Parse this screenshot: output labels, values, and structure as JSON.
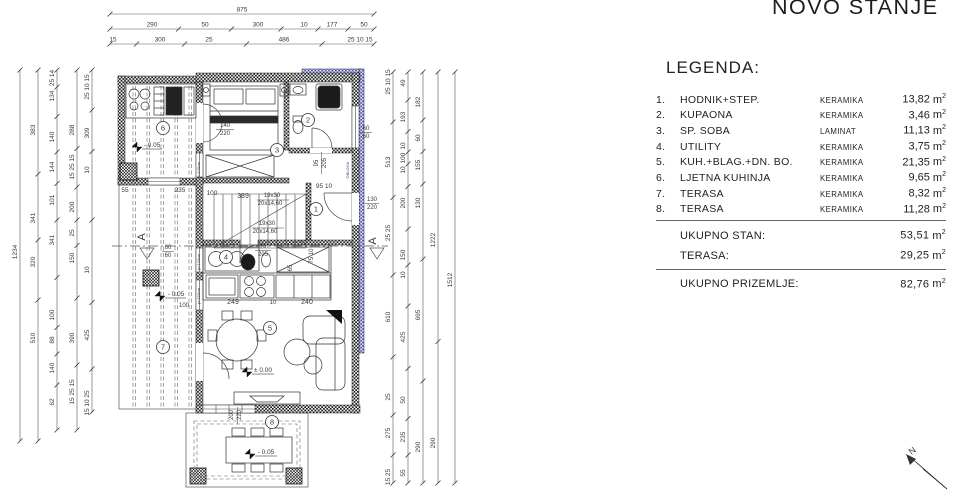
{
  "title": "NOVO STANJE",
  "legend": {
    "heading": "LEGENDA:",
    "unit": "m",
    "unit_sup": "2",
    "items": [
      {
        "num": "1.",
        "name": "HODNIK+STEP.",
        "material": "KERAMIKA",
        "area": "13,82"
      },
      {
        "num": "2.",
        "name": "KUPAONA",
        "material": "KERAMIKA",
        "area": "3,46"
      },
      {
        "num": "3.",
        "name": "SP. SOBA",
        "material": "LAMINAT",
        "area": "11,13"
      },
      {
        "num": "4.",
        "name": "UTILITY",
        "material": "KERAMIKA",
        "area": "3,75"
      },
      {
        "num": "5.",
        "name": "KUH.+BLAG.+DN. BO.",
        "material": "KERAMIKA",
        "area": "21,35"
      },
      {
        "num": "6.",
        "name": "LJETNA KUHINJA",
        "material": "KERAMIKA",
        "area": "9,65"
      },
      {
        "num": "7.",
        "name": "TERASA",
        "material": "KERAMIKA",
        "area": "8,32"
      },
      {
        "num": "8.",
        "name": "TERASA",
        "material": "KERAMIKA",
        "area": "11,28"
      }
    ],
    "subtotals": [
      {
        "label": "UKUPNO STAN:",
        "area": "53,51"
      },
      {
        "label": "TERASA:",
        "area": "29,25"
      }
    ],
    "total": {
      "label": "UKUPNO PRIZEMLJE:",
      "area": "82,76"
    }
  },
  "plan": {
    "rooms": [
      {
        "n": "1",
        "x": 316,
        "y": 209
      },
      {
        "n": "2",
        "x": 308,
        "y": 120
      },
      {
        "n": "3",
        "x": 277,
        "y": 150
      },
      {
        "n": "4",
        "x": 226,
        "y": 257
      },
      {
        "n": "5",
        "x": 270,
        "y": 328
      },
      {
        "n": "6",
        "x": 163,
        "y": 128
      },
      {
        "n": "7",
        "x": 163,
        "y": 347
      },
      {
        "n": "8",
        "x": 272,
        "y": 422
      }
    ],
    "texts": [
      {
        "t": "140",
        "x": 225,
        "y": 127
      },
      {
        "t": "220",
        "x": 225,
        "y": 135
      },
      {
        "t": "- 0.05",
        "x": 152,
        "y": 147,
        "s": 6.5
      },
      {
        "t": "55",
        "x": 125,
        "y": 192,
        "s": 6.5
      },
      {
        "t": "235",
        "x": 180,
        "y": 192,
        "s": 6.5
      },
      {
        "t": "100",
        "x": 212,
        "y": 195,
        "s": 6.5
      },
      {
        "t": "389",
        "x": 243,
        "y": 198,
        "s": 7
      },
      {
        "t": "19x30",
        "x": 272,
        "y": 197,
        "s": 6
      },
      {
        "t": "20x14,60",
        "x": 270,
        "y": 205,
        "s": 6
      },
      {
        "t": "19x30",
        "x": 267,
        "y": 225,
        "s": 6
      },
      {
        "t": "20x14,60",
        "x": 265,
        "y": 233,
        "s": 6
      },
      {
        "t": "125",
        "x": 299,
        "y": 245,
        "s": 7
      },
      {
        "t": "95",
        "x": 318,
        "y": 163,
        "r": -90
      },
      {
        "t": "205",
        "x": 326,
        "y": 163,
        "r": -90
      },
      {
        "t": "95 10",
        "x": 324,
        "y": 188,
        "s": 6.5
      },
      {
        "t": "75",
        "x": 263,
        "y": 248
      },
      {
        "t": "205",
        "x": 263,
        "y": 256
      },
      {
        "t": "65",
        "x": 292,
        "y": 268,
        "r": -90
      },
      {
        "t": "75 10",
        "x": 313,
        "y": 256,
        "r": -90
      },
      {
        "t": "249",
        "x": 233,
        "y": 304,
        "s": 7
      },
      {
        "t": "10",
        "x": 273,
        "y": 304
      },
      {
        "t": "240",
        "x": 307,
        "y": 304,
        "s": 7
      },
      {
        "t": "± 0.00",
        "x": 263,
        "y": 372,
        "s": 6.5
      },
      {
        "t": "- 0.05",
        "x": 176,
        "y": 296,
        "s": 6.5
      },
      {
        "t": "100",
        "x": 184,
        "y": 307
      },
      {
        "t": "- 0.05",
        "x": 266,
        "y": 454,
        "s": 6.5
      },
      {
        "t": "200",
        "x": 233,
        "y": 415,
        "r": -90
      },
      {
        "t": "220",
        "x": 241,
        "y": 415,
        "r": -90
      },
      {
        "t": "60",
        "x": 366,
        "y": 130
      },
      {
        "t": "60",
        "x": 366,
        "y": 138
      },
      {
        "t": "130",
        "x": 372,
        "y": 201
      },
      {
        "t": "220",
        "x": 372,
        "y": 209
      },
      {
        "t": "60",
        "x": 168,
        "y": 249
      },
      {
        "t": "60",
        "x": 168,
        "y": 257
      },
      {
        "t": "p=100cm",
        "x": 200,
        "y": 170,
        "r": -90,
        "s": 4
      },
      {
        "t": "p=140cm",
        "x": 200,
        "y": 262,
        "r": -90,
        "s": 4
      },
      {
        "t": "p=160cm",
        "x": 200,
        "y": 296,
        "r": -90,
        "s": 4
      },
      {
        "t": "OBLOGA",
        "x": 349,
        "y": 170,
        "r": -90,
        "s": 4,
        "c": "#4040b0"
      },
      {
        "t": "A",
        "x": 145,
        "y": 237,
        "r": -90,
        "s": 11
      },
      {
        "t": "A",
        "x": 376,
        "y": 241,
        "r": -90,
        "s": 11
      },
      {
        "t": "N",
        "x": 914,
        "y": 453,
        "r": -38,
        "s": 9
      }
    ],
    "dims": {
      "top": [
        {
          "y": 14,
          "x1": 110,
          "x2": 374,
          "labels": [
            {
              "t": "875",
              "at": 242
            }
          ]
        },
        {
          "y": 29,
          "x1": 110,
          "x2": 374,
          "labels": [
            {
              "t": "290",
              "at": 152
            },
            {
              "t": "50",
              "at": 205
            },
            {
              "t": "300",
              "at": 258
            },
            {
              "t": "10",
              "at": 304
            },
            {
              "t": "177",
              "at": 332
            },
            {
              "t": "50",
              "at": 364
            }
          ]
        },
        {
          "y": 44,
          "x1": 110,
          "x2": 374,
          "labels": [
            {
              "t": "15",
              "at": 113
            },
            {
              "t": "300",
              "at": 160
            },
            {
              "t": "25",
              "at": 209
            },
            {
              "t": "486",
              "at": 284
            },
            {
              "t": "25 10 15",
              "at": 360
            }
          ]
        }
      ],
      "left": [
        {
          "x": 20,
          "y1": 70,
          "y2": 441,
          "labels": [
            {
              "t": "1234",
              "at": 252
            }
          ]
        },
        {
          "x": 38,
          "y1": 70,
          "y2": 441,
          "labels": [
            {
              "t": "383",
              "at": 130
            },
            {
              "t": "341",
              "at": 218
            },
            {
              "t": "320",
              "at": 262
            },
            {
              "t": "510",
              "at": 338
            }
          ]
        },
        {
          "x": 57,
          "y1": 70,
          "y2": 430,
          "labels": [
            {
              "t": "25 14",
              "at": 78
            },
            {
              "t": "134",
              "at": 96
            },
            {
              "t": "140",
              "at": 137
            },
            {
              "t": "144",
              "at": 167
            },
            {
              "t": "101",
              "at": 200
            },
            {
              "t": "341",
              "at": 240
            },
            {
              "t": "100",
              "at": 315
            },
            {
              "t": "88",
              "at": 340
            },
            {
              "t": "140",
              "at": 368
            },
            {
              "t": "62",
              "at": 402
            }
          ]
        },
        {
          "x": 77,
          "y1": 70,
          "y2": 430,
          "labels": [
            {
              "t": "288",
              "at": 130
            },
            {
              "t": "15 25 15",
              "at": 167
            },
            {
              "t": "200",
              "at": 207
            },
            {
              "t": "25",
              "at": 233
            },
            {
              "t": "150",
              "at": 258
            },
            {
              "t": "390",
              "at": 338
            },
            {
              "t": "15 25 15",
              "at": 392
            }
          ]
        },
        {
          "x": 92,
          "y1": 70,
          "y2": 412,
          "labels": [
            {
              "t": "25 10 15",
              "at": 87
            },
            {
              "t": "309",
              "at": 133
            },
            {
              "t": "10",
              "at": 170
            },
            {
              "t": "10",
              "at": 270
            },
            {
              "t": "425",
              "at": 335
            },
            {
              "t": "15 10 25",
              "at": 403
            }
          ]
        }
      ],
      "right": [
        {
          "x": 393,
          "y1": 72,
          "y2": 483,
          "labels": [
            {
              "t": "25 10 15",
              "at": 82
            },
            {
              "t": "513",
              "at": 162
            },
            {
              "t": "25 25",
              "at": 233
            },
            {
              "t": "610",
              "at": 317
            },
            {
              "t": "25",
              "at": 397
            },
            {
              "t": "275",
              "at": 433
            },
            {
              "t": "15 25",
              "at": 477
            }
          ]
        },
        {
          "x": 408,
          "y1": 72,
          "y2": 483,
          "labels": [
            {
              "t": "49",
              "at": 83
            },
            {
              "t": "193",
              "at": 117
            },
            {
              "t": "10",
              "at": 146
            },
            {
              "t": "100",
              "at": 158
            },
            {
              "t": "10",
              "at": 170
            },
            {
              "t": "200",
              "at": 203
            },
            {
              "t": "150",
              "at": 255
            },
            {
              "t": "10",
              "at": 275
            },
            {
              "t": "425",
              "at": 337
            },
            {
              "t": "50",
              "at": 400
            },
            {
              "t": "235",
              "at": 437
            },
            {
              "t": "55",
              "at": 473
            }
          ]
        },
        {
          "x": 423,
          "y1": 72,
          "y2": 483,
          "labels": [
            {
              "t": "182",
              "at": 102
            },
            {
              "t": "60",
              "at": 138
            },
            {
              "t": "155",
              "at": 165
            },
            {
              "t": "130",
              "at": 203
            },
            {
              "t": "695",
              "at": 315
            },
            {
              "t": "290",
              "at": 447
            }
          ]
        },
        {
          "x": 438,
          "y1": 72,
          "y2": 483,
          "labels": [
            {
              "t": "1222",
              "at": 240
            },
            {
              "t": "290",
              "at": 443
            }
          ]
        },
        {
          "x": 455,
          "y1": 72,
          "y2": 483,
          "labels": [
            {
              "t": "1512",
              "at": 280
            }
          ]
        }
      ]
    }
  }
}
